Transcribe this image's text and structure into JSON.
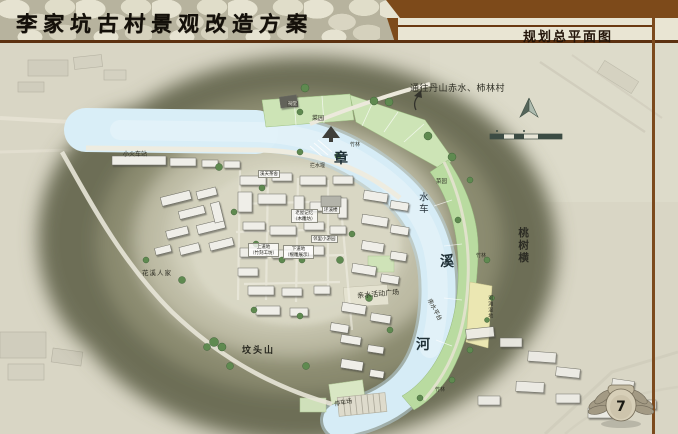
{
  "header": {
    "title": "李家坑古村景观改造方案",
    "subtitle": "规划总平面图"
  },
  "map": {
    "river_name": "章溪河",
    "labels": [
      {
        "text": "通往丹山赤水、柿林村"
      },
      {
        "text": "小火车站"
      },
      {
        "text": "菜园"
      },
      {
        "text": "竹林"
      },
      {
        "text": "拦水堰"
      },
      {
        "text": "溪天茶舍"
      },
      {
        "text": "章"
      },
      {
        "text": "菜园"
      },
      {
        "text": "水车"
      },
      {
        "text": "桃树横"
      },
      {
        "text": "溪"
      },
      {
        "text": "竹林"
      },
      {
        "text": "环溪楼"
      },
      {
        "text": "老屋记忆\n（木雕坊）"
      },
      {
        "text": "上道地\n（竹刻工坊）"
      },
      {
        "text": "下道地\n（根雕展示）"
      },
      {
        "text": "邻里小游园"
      },
      {
        "text": "花溪人家"
      },
      {
        "text": "亲水活动广场"
      },
      {
        "text": "亲水平台"
      },
      {
        "text": "河滩湿地"
      },
      {
        "text": "河"
      },
      {
        "text": "坟头山"
      },
      {
        "text": "竹林"
      },
      {
        "text": "停车场"
      },
      {
        "text": "祠堂"
      }
    ]
  },
  "icons": {
    "north_arrow": "north-arrow-icon",
    "scale_bar": "scale-bar-icon",
    "route_arrow": "curved-arrow-icon",
    "page_emblem": "winged-stone-emblem"
  },
  "colors": {
    "header_brown": "#7d4a1a",
    "rule_brown": "#5c3110",
    "paper": "#d9d6c5",
    "hill_dark": "#6d6e57",
    "river_blue": "#d6ecf6",
    "field_green": "#cde4b6",
    "bank_green": "#b9dba0",
    "wetland_yellow": "#ebe7b2",
    "tree_green": "#5f8a50"
  },
  "footer": {
    "page_number": "7"
  }
}
